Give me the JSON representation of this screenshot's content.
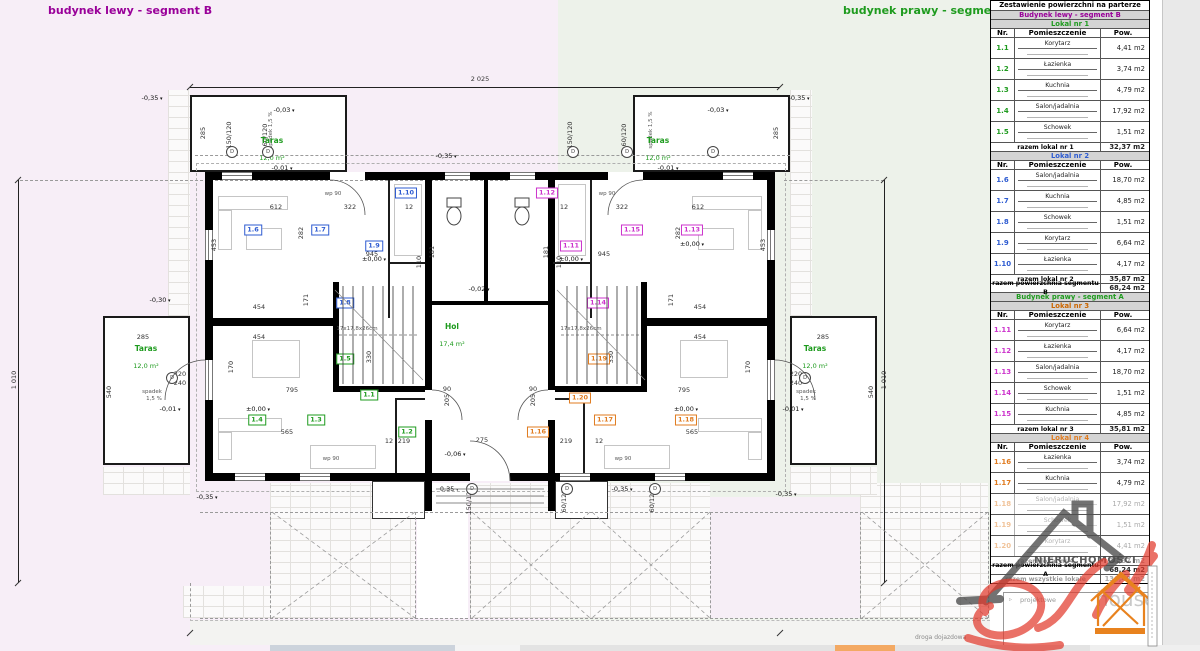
{
  "titles": {
    "left": "budynek lewy - segment B",
    "right": "budynek prawy - segment A"
  },
  "colors": {
    "purple": "#990099",
    "green": "#1e9b1e",
    "blue": "#2d5bd1",
    "magenta": "#cc33cc",
    "orange": "#e07b1f",
    "lokal3_header": "#cc6600",
    "table_header_bg": "#d4d4d4",
    "watermark_red": "#e23b2e",
    "watermark_gray": "#4f4f4f",
    "logo_orange": "#e8821e",
    "bg_left": "#f7eef7",
    "bg_right": "#edf2ea"
  },
  "plan": {
    "taras": {
      "label": "Taras",
      "area": "12,0 m²",
      "positions": [
        {
          "x": 272,
          "y": 150
        },
        {
          "x": 658,
          "y": 150
        },
        {
          "x": 146,
          "y": 358
        },
        {
          "x": 815,
          "y": 358
        }
      ]
    },
    "hol": {
      "label": "Hol",
      "area": "17,4 m²"
    },
    "road_label": "droga dojazdowa",
    "dims": [
      {
        "t": "2 025",
        "x": 480,
        "y": 79
      },
      {
        "t": "2 025",
        "x": 480,
        "y": 626
      },
      {
        "t": "1 010",
        "x": 14,
        "y": 380,
        "r": 1
      },
      {
        "t": "1 010",
        "x": 884,
        "y": 380,
        "r": 1
      },
      {
        "t": "285",
        "x": 203,
        "y": 133,
        "r": 1
      },
      {
        "t": "285",
        "x": 776,
        "y": 133,
        "r": 1
      },
      {
        "t": "612",
        "x": 276,
        "y": 207
      },
      {
        "t": "612",
        "x": 698,
        "y": 207
      },
      {
        "t": "322",
        "x": 350,
        "y": 207
      },
      {
        "t": "322",
        "x": 622,
        "y": 207
      },
      {
        "t": "12",
        "x": 409,
        "y": 207
      },
      {
        "t": "12",
        "x": 564,
        "y": 207
      },
      {
        "t": "945",
        "x": 372,
        "y": 254
      },
      {
        "t": "945",
        "x": 604,
        "y": 254
      },
      {
        "t": "453",
        "x": 214,
        "y": 245,
        "r": 1
      },
      {
        "t": "453",
        "x": 763,
        "y": 245,
        "r": 1
      },
      {
        "t": "282",
        "x": 301,
        "y": 233,
        "r": 1
      },
      {
        "t": "282",
        "x": 678,
        "y": 233,
        "r": 1
      },
      {
        "t": "181",
        "x": 432,
        "y": 252,
        "r": 1
      },
      {
        "t": "181",
        "x": 546,
        "y": 252,
        "r": 1
      },
      {
        "t": "110",
        "x": 419,
        "y": 262,
        "r": 1
      },
      {
        "t": "110",
        "x": 559,
        "y": 262,
        "r": 1
      },
      {
        "t": "454",
        "x": 259,
        "y": 307
      },
      {
        "t": "454",
        "x": 700,
        "y": 307
      },
      {
        "t": "454",
        "x": 259,
        "y": 337
      },
      {
        "t": "454",
        "x": 700,
        "y": 337
      },
      {
        "t": "171",
        "x": 306,
        "y": 300,
        "r": 1
      },
      {
        "t": "171",
        "x": 671,
        "y": 300,
        "r": 1
      },
      {
        "t": "170",
        "x": 231,
        "y": 367,
        "r": 1
      },
      {
        "t": "170",
        "x": 748,
        "y": 367,
        "r": 1
      },
      {
        "t": "795",
        "x": 292,
        "y": 390
      },
      {
        "t": "795",
        "x": 684,
        "y": 390
      },
      {
        "t": "565",
        "x": 287,
        "y": 432
      },
      {
        "t": "565",
        "x": 692,
        "y": 432
      },
      {
        "t": "219",
        "x": 404,
        "y": 441
      },
      {
        "t": "219",
        "x": 566,
        "y": 441
      },
      {
        "t": "275",
        "x": 482,
        "y": 440
      },
      {
        "t": "12",
        "x": 389,
        "y": 441
      },
      {
        "t": "12",
        "x": 599,
        "y": 441
      },
      {
        "t": "330",
        "x": 369,
        "y": 357,
        "r": 1
      },
      {
        "t": "330",
        "x": 611,
        "y": 357,
        "r": 1
      },
      {
        "t": "90",
        "x": 447,
        "y": 389
      },
      {
        "t": "90",
        "x": 533,
        "y": 389
      },
      {
        "t": "205",
        "x": 447,
        "y": 400,
        "r": 1
      },
      {
        "t": "205",
        "x": 533,
        "y": 400,
        "r": 1
      },
      {
        "t": "285",
        "x": 143,
        "y": 337
      },
      {
        "t": "285",
        "x": 823,
        "y": 337
      },
      {
        "t": "540",
        "x": 109,
        "y": 392,
        "r": 1
      },
      {
        "t": "540",
        "x": 871,
        "y": 392,
        "r": 1
      },
      {
        "t": "220",
        "x": 180,
        "y": 374
      },
      {
        "t": "240",
        "x": 180,
        "y": 383
      },
      {
        "t": "220",
        "x": 796,
        "y": 374
      },
      {
        "t": "240",
        "x": 796,
        "y": 383
      },
      {
        "t": "150/120",
        "x": 229,
        "y": 135,
        "r": 1
      },
      {
        "t": "60/120",
        "x": 265,
        "y": 135,
        "r": 1
      },
      {
        "t": "150/120",
        "x": 570,
        "y": 135,
        "r": 1
      },
      {
        "t": "60/120",
        "x": 624,
        "y": 135,
        "r": 1
      },
      {
        "t": "150/120",
        "x": 469,
        "y": 501,
        "r": 1
      },
      {
        "t": "60/120",
        "x": 564,
        "y": 501,
        "r": 1
      },
      {
        "t": "60/120",
        "x": 652,
        "y": 501,
        "r": 1
      }
    ],
    "levels": [
      {
        "t": "-0,35",
        "x": 152,
        "y": 98
      },
      {
        "t": "-0,35",
        "x": 446,
        "y": 156
      },
      {
        "t": "-0,35",
        "x": 799,
        "y": 98
      },
      {
        "t": "-0,35",
        "x": 207,
        "y": 497
      },
      {
        "t": "-0,35",
        "x": 448,
        "y": 489
      },
      {
        "t": "-0,35",
        "x": 622,
        "y": 489
      },
      {
        "t": "-0,35",
        "x": 786,
        "y": 494
      },
      {
        "t": "-0,03",
        "x": 284,
        "y": 110
      },
      {
        "t": "-0,03",
        "x": 718,
        "y": 110
      },
      {
        "t": "-0,30",
        "x": 160,
        "y": 300
      },
      {
        "t": "-0,01",
        "x": 282,
        "y": 168
      },
      {
        "t": "-0,01",
        "x": 668,
        "y": 168
      },
      {
        "t": "-0,01",
        "x": 170,
        "y": 409
      },
      {
        "t": "-0,01",
        "x": 793,
        "y": 409
      },
      {
        "t": "-0,02",
        "x": 479,
        "y": 289
      },
      {
        "t": "-0,06",
        "x": 455,
        "y": 454
      },
      {
        "t": "±0,00",
        "x": 374,
        "y": 259
      },
      {
        "t": "±0,00",
        "x": 571,
        "y": 259
      },
      {
        "t": "±0,00",
        "x": 258,
        "y": 409
      },
      {
        "t": "±0,00",
        "x": 692,
        "y": 244
      },
      {
        "t": "±0,00",
        "x": 686,
        "y": 409
      }
    ],
    "rooms": [
      {
        "no": "1.6",
        "x": 253,
        "y": 230,
        "c": "#2d5bd1"
      },
      {
        "no": "1.7",
        "x": 320,
        "y": 230,
        "c": "#2d5bd1"
      },
      {
        "no": "1.10",
        "x": 406,
        "y": 193,
        "c": "#2d5bd1"
      },
      {
        "no": "1.9",
        "x": 374,
        "y": 246,
        "c": "#2d5bd1"
      },
      {
        "no": "1.8",
        "x": 345,
        "y": 303,
        "c": "#2d5bd1"
      },
      {
        "no": "1.4",
        "x": 257,
        "y": 420,
        "c": "#1e9b1e"
      },
      {
        "no": "1.3",
        "x": 316,
        "y": 420,
        "c": "#1e9b1e"
      },
      {
        "no": "1.1",
        "x": 369,
        "y": 395,
        "c": "#1e9b1e"
      },
      {
        "no": "1.5",
        "x": 345,
        "y": 359,
        "c": "#1e9b1e"
      },
      {
        "no": "1.2",
        "x": 407,
        "y": 432,
        "c": "#1e9b1e"
      },
      {
        "no": "1.12",
        "x": 547,
        "y": 193,
        "c": "#cc33cc"
      },
      {
        "no": "1.11",
        "x": 571,
        "y": 246,
        "c": "#cc33cc"
      },
      {
        "no": "1.15",
        "x": 632,
        "y": 230,
        "c": "#cc33cc"
      },
      {
        "no": "1.13",
        "x": 692,
        "y": 230,
        "c": "#cc33cc"
      },
      {
        "no": "1.14",
        "x": 598,
        "y": 303,
        "c": "#cc33cc"
      },
      {
        "no": "1.20",
        "x": 580,
        "y": 398,
        "c": "#e07b1f"
      },
      {
        "no": "1.19",
        "x": 599,
        "y": 359,
        "c": "#e07b1f"
      },
      {
        "no": "1.16",
        "x": 538,
        "y": 432,
        "c": "#e07b1f"
      },
      {
        "no": "1.17",
        "x": 605,
        "y": 420,
        "c": "#e07b1f"
      },
      {
        "no": "1.18",
        "x": 686,
        "y": 420,
        "c": "#e07b1f"
      }
    ],
    "notes": [
      {
        "t": "wp 90",
        "x": 333,
        "y": 194
      },
      {
        "t": "wp 90",
        "x": 607,
        "y": 194
      },
      {
        "t": "wp 90",
        "x": 331,
        "y": 459
      },
      {
        "t": "wp 90",
        "x": 623,
        "y": 459
      },
      {
        "t": "spadek",
        "x": 152,
        "y": 392
      },
      {
        "t": "1,5 %",
        "x": 154,
        "y": 399
      },
      {
        "t": "spadek",
        "x": 806,
        "y": 392
      },
      {
        "t": "1,5 %",
        "x": 808,
        "y": 399
      },
      {
        "t": "spadek 1,5 %",
        "x": 271,
        "y": 130,
        "r": 1
      },
      {
        "t": "spadek 1,5 %",
        "x": 651,
        "y": 130,
        "r": 1
      },
      {
        "t": "17x17,8x26cm",
        "x": 357,
        "y": 329
      },
      {
        "t": "17x17,8x26cm",
        "x": 581,
        "y": 329
      }
    ]
  },
  "table": {
    "cols": {
      "nr": "Nr.",
      "room": "Pomieszczenie",
      "area": "Pow."
    },
    "rows": [
      {
        "type": "title",
        "text": "Zestawienie powierzchni na parterze"
      },
      {
        "type": "building",
        "text": "Budynek lewy - segment B",
        "color": "#990099"
      },
      {
        "type": "lokal",
        "text": "Lokal nr 1",
        "color": "#1e9b1e"
      },
      {
        "type": "cols"
      },
      {
        "type": "data",
        "nr": "1.1",
        "room": "Korytarz",
        "area": "4,41 m2",
        "color": "#1e9b1e"
      },
      {
        "type": "data",
        "nr": "1.2",
        "room": "Łazienka",
        "area": "3,74 m2",
        "color": "#1e9b1e"
      },
      {
        "type": "data",
        "nr": "1.3",
        "room": "Kuchnia",
        "area": "4,79 m2",
        "color": "#1e9b1e"
      },
      {
        "type": "data",
        "nr": "1.4",
        "room": "Salon/jadalnia",
        "area": "17,92 m2",
        "color": "#1e9b1e"
      },
      {
        "type": "data",
        "nr": "1.5",
        "room": "Schowek",
        "area": "1,51 m2",
        "color": "#1e9b1e"
      },
      {
        "type": "sum",
        "label": "razem lokal nr 1",
        "area": "32,37 m2"
      },
      {
        "type": "lokal",
        "text": "Lokal nr 2",
        "color": "#2d5bd1"
      },
      {
        "type": "cols"
      },
      {
        "type": "data",
        "nr": "1.6",
        "room": "Salon/jadalnia",
        "area": "18,70 m2",
        "color": "#2d5bd1"
      },
      {
        "type": "data",
        "nr": "1.7",
        "room": "Kuchnia",
        "area": "4,85 m2",
        "color": "#2d5bd1"
      },
      {
        "type": "data",
        "nr": "1.8",
        "room": "Schowek",
        "area": "1,51 m2",
        "color": "#2d5bd1"
      },
      {
        "type": "data",
        "nr": "1.9",
        "room": "Korytarz",
        "area": "6,64 m2",
        "color": "#2d5bd1"
      },
      {
        "type": "data",
        "nr": "1.10",
        "room": "Łazienka",
        "area": "4,17 m2",
        "color": "#2d5bd1"
      },
      {
        "type": "sum",
        "label": "razem lokal nr 2",
        "area": "35,87 m2"
      },
      {
        "type": "sum",
        "label": "razem powierzchnia segmentu B",
        "area": "68,24 m2"
      },
      {
        "type": "building",
        "text": "Budynek prawy - segment A",
        "color": "#1e9b1e"
      },
      {
        "type": "lokal",
        "text": "Lokal nr 3",
        "color": "#cc6600"
      },
      {
        "type": "cols"
      },
      {
        "type": "data",
        "nr": "1.11",
        "room": "Korytarz",
        "area": "6,64 m2",
        "color": "#cc33cc"
      },
      {
        "type": "data",
        "nr": "1.12",
        "room": "Łazienka",
        "area": "4,17 m2",
        "color": "#cc33cc"
      },
      {
        "type": "data",
        "nr": "1.13",
        "room": "Salon/jadalnia",
        "area": "18,70 m2",
        "color": "#cc33cc"
      },
      {
        "type": "data",
        "nr": "1.14",
        "room": "Schowek",
        "area": "1,51 m2",
        "color": "#cc33cc"
      },
      {
        "type": "data",
        "nr": "1.15",
        "room": "Kuchnia",
        "area": "4,85 m2",
        "color": "#cc33cc"
      },
      {
        "type": "sum",
        "label": "razem lokal nr 3",
        "area": "35,81 m2"
      },
      {
        "type": "lokal",
        "text": "Lokal nr 4",
        "color": "#e07b1f"
      },
      {
        "type": "cols"
      },
      {
        "type": "data",
        "nr": "1.16",
        "room": "Łazienka",
        "area": "3,74 m2",
        "color": "#e07b1f"
      },
      {
        "type": "data",
        "nr": "1.17",
        "room": "Kuchnia",
        "area": "4,79 m2",
        "color": "#e07b1f"
      },
      {
        "type": "data",
        "nr": "1.18",
        "room": "Salon/jadalnia",
        "area": "17,92 m2",
        "color": "#e07b1f",
        "faded": true
      },
      {
        "type": "data",
        "nr": "1.19",
        "room": "Schowek",
        "area": "1,51 m2",
        "color": "#e07b1f",
        "faded": true
      },
      {
        "type": "data",
        "nr": "1.20",
        "room": "Korytarz",
        "area": "4,41 m2",
        "color": "#e07b1f",
        "faded": true
      },
      {
        "type": "sum",
        "label": "razem lokal nr 4",
        "area": "32,37 m2",
        "faded": true
      },
      {
        "type": "sum",
        "label": "razem powierzchnia segmentu A",
        "area": "68,24 m2"
      },
      {
        "type": "sum",
        "label": "razem wszystkie lokale",
        "area": "136,48 m2",
        "faded": true
      }
    ]
  },
  "stamp": {
    "text": "projektowe"
  },
  "watermark": {
    "line1": "NIERUCHOMOŚCI",
    "line2": "house"
  }
}
